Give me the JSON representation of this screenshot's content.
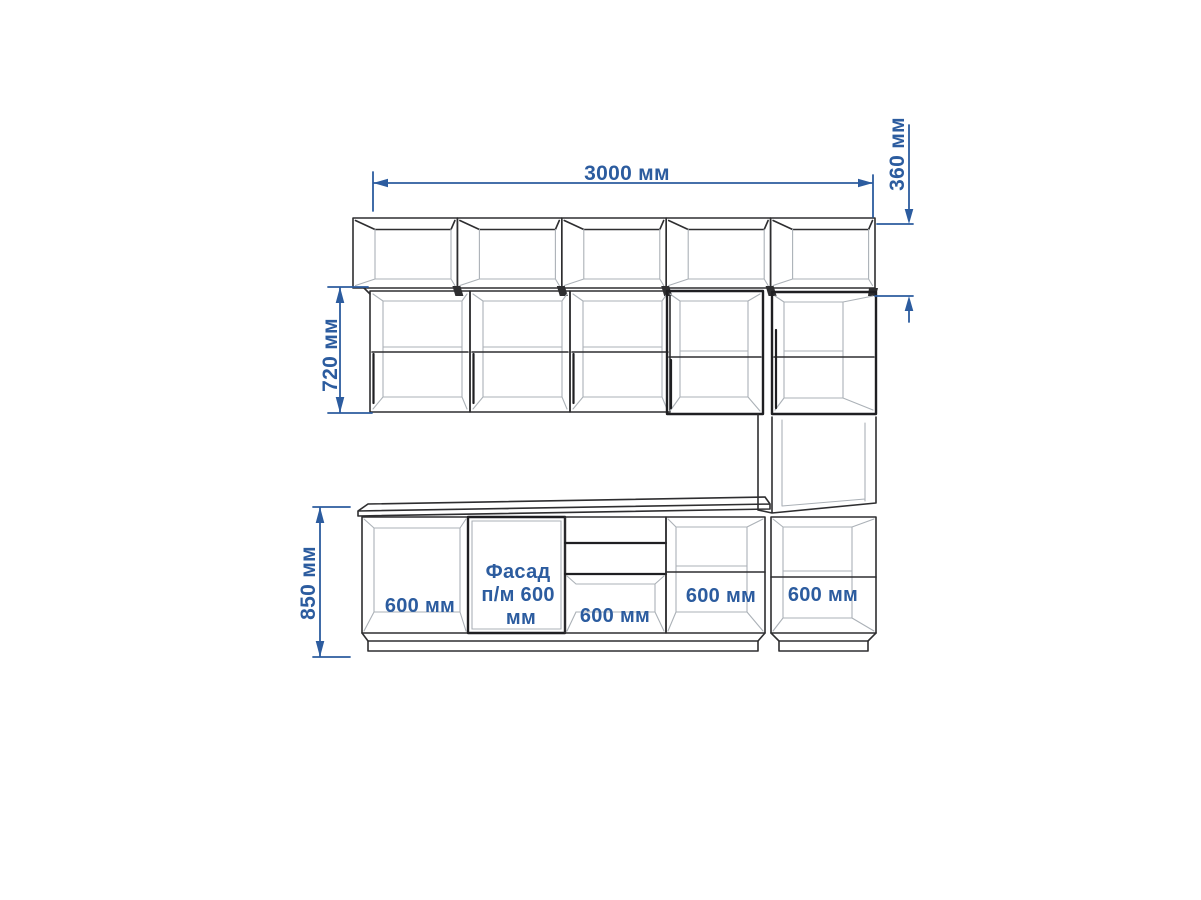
{
  "drawing": {
    "type": "kitchen elevation with dimensions",
    "colors": {
      "dimension_blue": "#2c5c9f",
      "outline_dark": "#2e2e30",
      "outline_light": "#abb1b7",
      "background": "#ffffff"
    },
    "dimensions": {
      "total_width": "3000 мм",
      "top_row_height": "360 мм",
      "wall_row_height": "720 мм",
      "base_row_height": "850 мм"
    },
    "labels": {
      "base_cabinet_1": "600 мм",
      "sink_facade": {
        "text": "Фасад п/м 600 мм",
        "lines": [
          "Фасад",
          "п/м 600",
          "мм"
        ]
      },
      "drawer_cabinet": "600 мм",
      "base_cabinet_4": "600 мм",
      "column_base_cabinet": "600 мм"
    }
  }
}
